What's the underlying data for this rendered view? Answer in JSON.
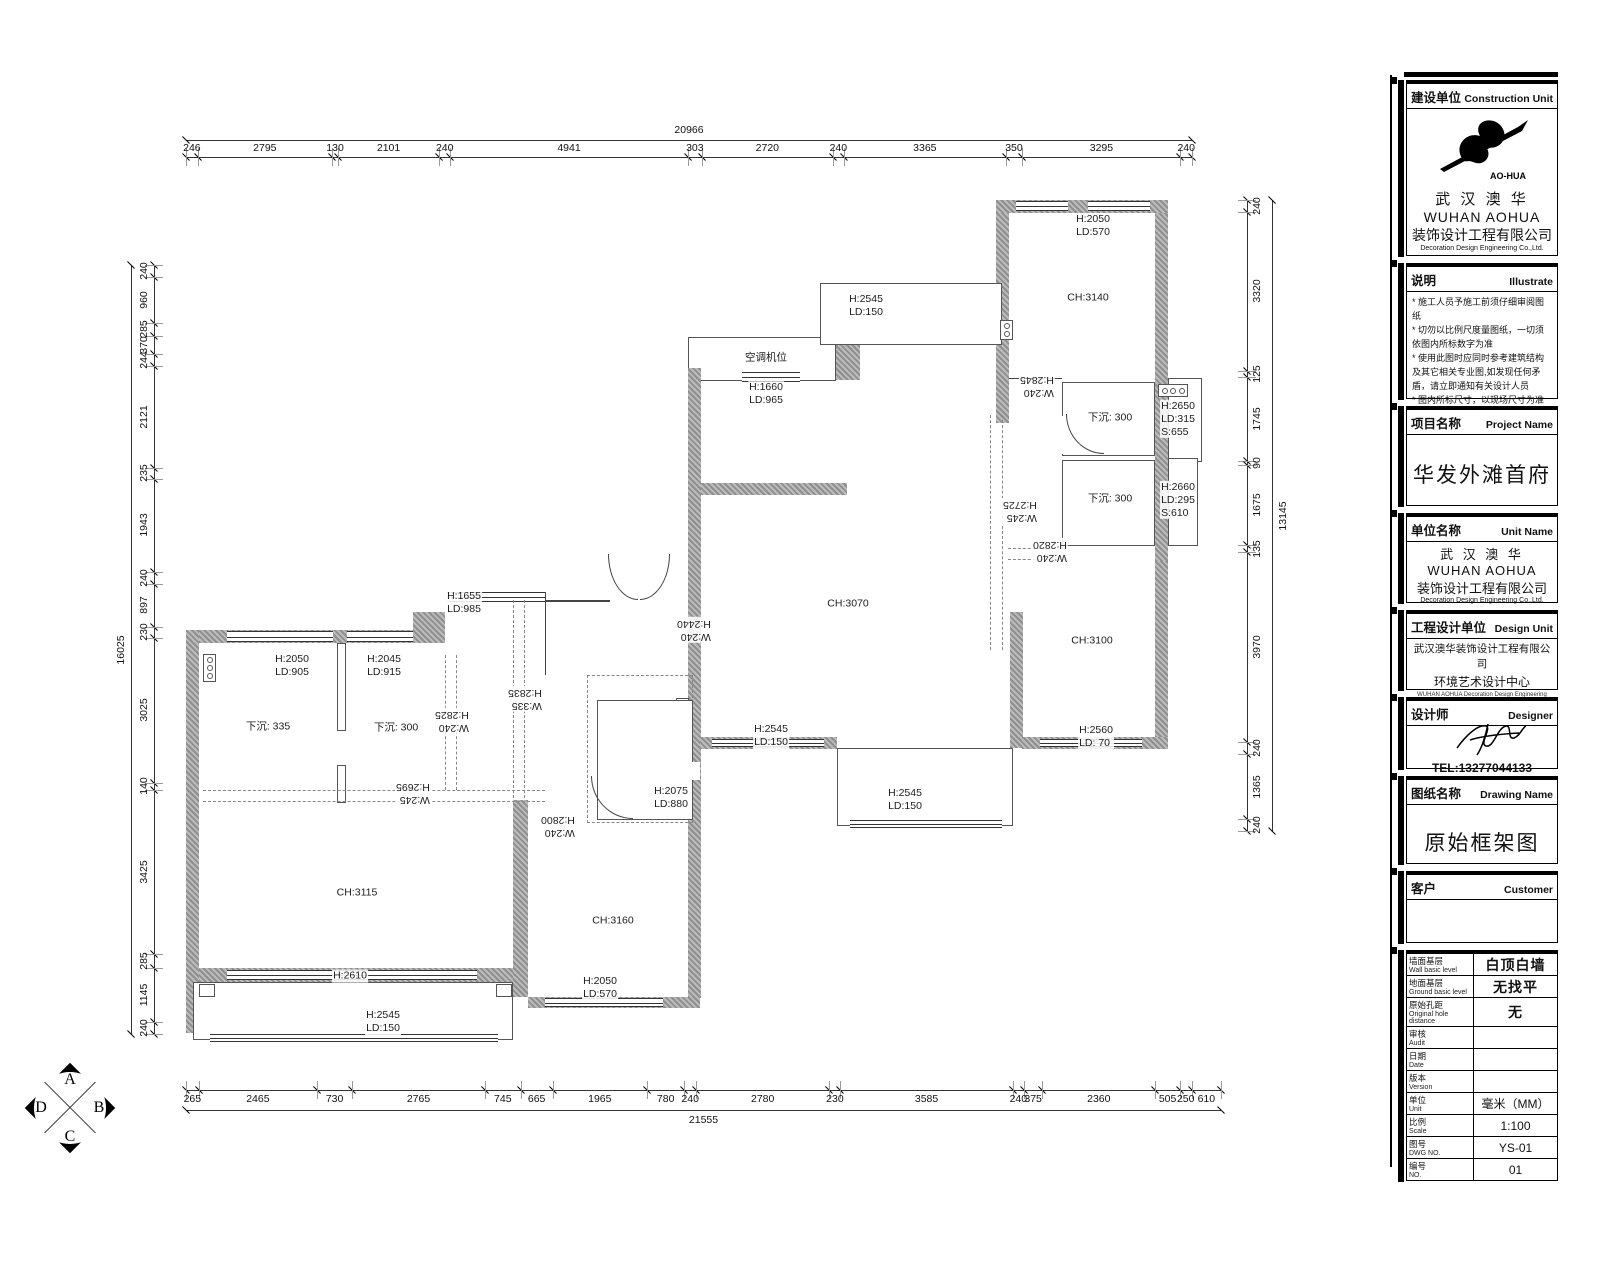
{
  "compass": {
    "top": "A",
    "right": "B",
    "bottom": "C",
    "left": "D"
  },
  "dims": {
    "top": {
      "total": "20966",
      "segments": [
        246,
        2795,
        130,
        2101,
        240,
        4941,
        303,
        2720,
        240,
        3365,
        350,
        3295,
        240
      ]
    },
    "bottom": {
      "total": "21555",
      "segments": [
        265,
        2465,
        730,
        2765,
        745,
        665,
        1965,
        780,
        240,
        2780,
        230,
        3585,
        240,
        375,
        2360,
        505,
        250,
        610
      ]
    },
    "left": {
      "total": "16025",
      "segments": [
        240,
        960,
        285,
        370,
        244,
        2121,
        235,
        1943,
        240,
        897,
        230,
        3025,
        140,
        3425,
        285,
        1145,
        240
      ]
    },
    "right": {
      "total": "13145",
      "segments": [
        240,
        3320,
        125,
        1745,
        90,
        1675,
        135,
        3970,
        240,
        1365,
        240
      ]
    }
  },
  "plan_labels": [
    {
      "text": "H:2545\nLD:150",
      "x": 866,
      "y": 306
    },
    {
      "text": "空调机位",
      "x": 766,
      "y": 358
    },
    {
      "text": "H:1660\nLD:965",
      "x": 766,
      "y": 394
    },
    {
      "text": "H:2050\nLD:570",
      "x": 1093,
      "y": 226
    },
    {
      "text": "CH:3140",
      "x": 1088,
      "y": 298
    },
    {
      "text": "W:240\nH:2845",
      "x": 1037,
      "y": 386,
      "rot": 180
    },
    {
      "text": "下沉: 300",
      "x": 1110,
      "y": 418
    },
    {
      "text": "H:2650\nLD:315\nS:655",
      "x": 1178,
      "y": 419
    },
    {
      "text": "下沉: 300",
      "x": 1110,
      "y": 499
    },
    {
      "text": "H:2660\nLD:295\nS:610",
      "x": 1178,
      "y": 500
    },
    {
      "text": "W:245\nH:2725",
      "x": 1020,
      "y": 511,
      "rot": 180
    },
    {
      "text": "W:240\nH:2820",
      "x": 1050,
      "y": 551,
      "rot": 180
    },
    {
      "text": "CH:3070",
      "x": 848,
      "y": 604
    },
    {
      "text": "CH:3100",
      "x": 1092,
      "y": 641
    },
    {
      "text": "H:1655\nLD:985",
      "x": 464,
      "y": 603
    },
    {
      "text": "W:240\nH:2440",
      "x": 694,
      "y": 630,
      "rot": 180
    },
    {
      "text": "H:2050\nLD:905",
      "x": 292,
      "y": 666
    },
    {
      "text": "H:2045\nLD:915",
      "x": 384,
      "y": 666
    },
    {
      "text": "W:335\nH:2835",
      "x": 525,
      "y": 699,
      "rot": 180
    },
    {
      "text": "下沉: 335",
      "x": 268,
      "y": 727
    },
    {
      "text": "下沉: 300",
      "x": 396,
      "y": 728
    },
    {
      "text": "W:240\nH:2825",
      "x": 452,
      "y": 721,
      "rot": 180
    },
    {
      "text": "H:2545\nLD:150",
      "x": 771,
      "y": 736
    },
    {
      "text": "H:2560\nLD: 70",
      "x": 1096,
      "y": 737
    },
    {
      "text": "W:245\nH:2695",
      "x": 413,
      "y": 793,
      "rot": 180
    },
    {
      "text": "H:2075\nLD:880",
      "x": 671,
      "y": 798
    },
    {
      "text": "W:240\nH:2800",
      "x": 558,
      "y": 826,
      "rot": 180
    },
    {
      "text": "H:2545\nLD:150",
      "x": 905,
      "y": 800
    },
    {
      "text": "CH:3115",
      "x": 357,
      "y": 893
    },
    {
      "text": "CH:3160",
      "x": 613,
      "y": 921
    },
    {
      "text": "H:2610",
      "x": 350,
      "y": 976
    },
    {
      "text": "H:2050\nLD:570",
      "x": 600,
      "y": 988
    },
    {
      "text": "H:2545\nLD:150",
      "x": 383,
      "y": 1022
    }
  ],
  "title_block": {
    "construction_unit": {
      "label_cn": "建设单位",
      "label_en": "Construction Unit",
      "logo_caption": "AO-HUA",
      "company_cn": "武 汉 澳 华",
      "company_en": "WUHAN AOHUA",
      "company_cn2": "装饰设计工程有限公司",
      "company_en2": "Decoration Design Engineering Co.,Ltd."
    },
    "illustrate": {
      "label_cn": "说明",
      "label_en": "Illustrate",
      "notes": [
        "* 施工人员予施工前须仔细审阅图纸",
        "* 切勿以比例尺度量图纸，一切须依图内所标数字为准",
        "* 使用此图时应同时参考建筑结构及其它相关专业图,如发现任何矛盾，请立即通知有关设计人员",
        "* 图内所标尺寸，以现场尺寸为准",
        "* 建筑结构以设计院建筑结构图为准",
        "* 未加盖本公司设计图章不准在施工中使用"
      ]
    },
    "project": {
      "label_cn": "项目名称",
      "label_en": "Project Name",
      "value": "华发外滩首府"
    },
    "unit": {
      "label_cn": "单位名称",
      "label_en": "Unit Name",
      "company_cn": "武 汉 澳 华",
      "company_en": "WUHAN AOHUA",
      "company_cn2": "装饰设计工程有限公司",
      "company_en2": "Decoration Design Engineering Co.,Ltd."
    },
    "design_unit": {
      "label_cn": "工程设计单位",
      "label_en": "Design Unit",
      "line1": "武汉澳华装饰设计工程有限公司",
      "line2": "环境艺术设计中心",
      "line3": "WUHAN AOHUA Decoration Design Engineering Co.,Ltd",
      "line4": "Environmental Art Design Center"
    },
    "designer": {
      "label_cn": "设计师",
      "label_en": "Designer",
      "tel": "TEL:13277044133"
    },
    "drawing": {
      "label_cn": "图纸名称",
      "label_en": "Drawing Name",
      "value": "原始框架图"
    },
    "customer": {
      "label_cn": "客户",
      "label_en": "Customer",
      "value": ""
    },
    "info_rows": [
      {
        "cn": "墙面基层",
        "en": "Wall basic level",
        "value": "白顶白墙",
        "big": true
      },
      {
        "cn": "地面基层",
        "en": "Ground basic level",
        "value": "无找平",
        "big": true
      },
      {
        "cn": "原始孔距",
        "en": "Original hole distance",
        "value": "无",
        "big": true
      },
      {
        "cn": "审核",
        "en": "Audit",
        "value": ""
      },
      {
        "cn": "日期",
        "en": "Date",
        "value": ""
      },
      {
        "cn": "版本",
        "en": "Version",
        "value": ""
      },
      {
        "cn": "单位",
        "en": "Unit",
        "value": "毫米（MM）"
      },
      {
        "cn": "比例",
        "en": "Scale",
        "value": "1:100"
      },
      {
        "cn": "图号",
        "en": "DWG NO.",
        "value": "YS-01"
      },
      {
        "cn": "编号",
        "en": "NO.",
        "value": "01"
      }
    ]
  }
}
